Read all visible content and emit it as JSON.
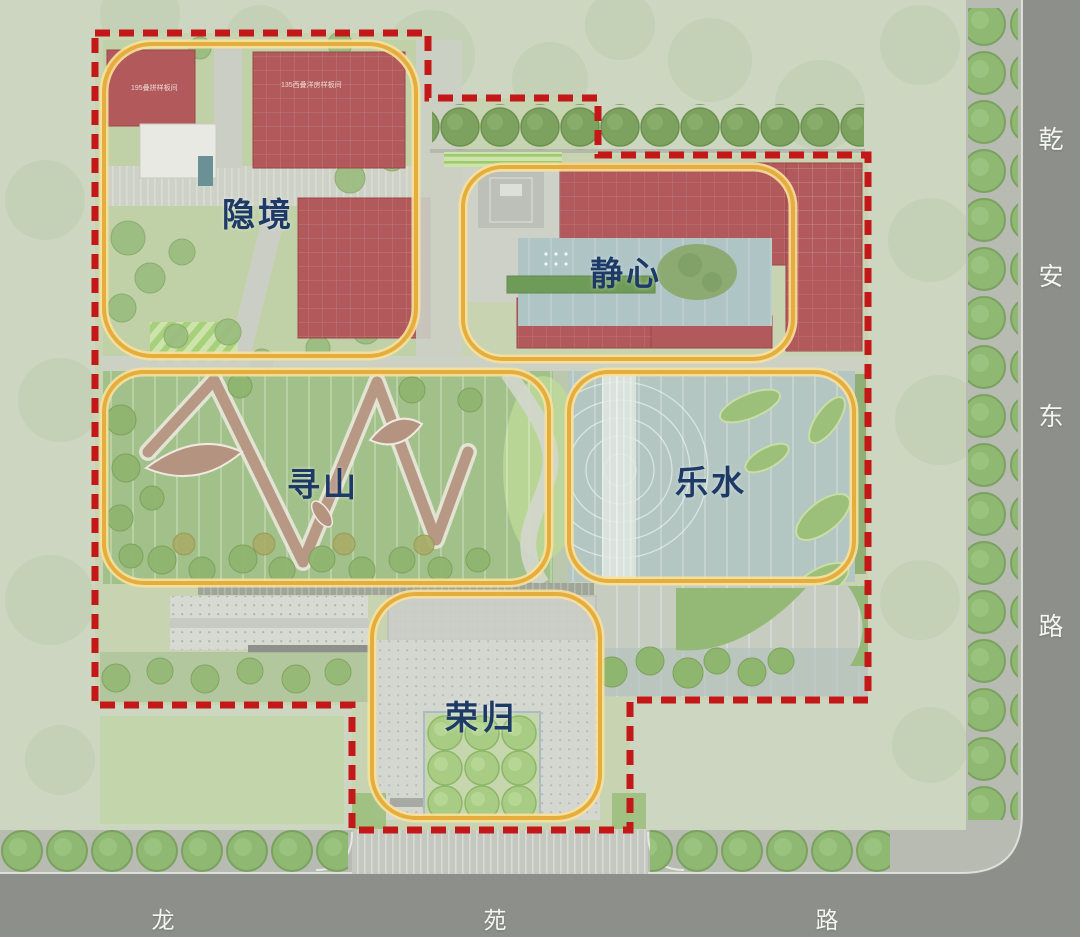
{
  "zones": [
    {
      "id": "yinjing",
      "label": "隐境"
    },
    {
      "id": "jingxin",
      "label": "静心"
    },
    {
      "id": "xunshan",
      "label": "寻山"
    },
    {
      "id": "leshui",
      "label": "乐水"
    },
    {
      "id": "ronggui",
      "label": "荣归"
    }
  ],
  "roads": {
    "east": {
      "name": "乾安东路",
      "chars": [
        "乾",
        "安",
        "东",
        "路"
      ]
    },
    "south": {
      "name": "龙苑路",
      "chars": [
        "龙",
        "苑",
        "路"
      ]
    }
  },
  "buildings": [
    {
      "label": "195叠拼样板间"
    },
    {
      "label": "135西叠洋房样板间"
    }
  ],
  "palette": {
    "boundary_red": "#c41717",
    "zone_outline_gold": "#e5ad3c",
    "zone_outline_halo": "#f8e09b",
    "label_navy": "#1d3a66",
    "road_gray": "#8d8f8b",
    "sidewalk_gray": "#b7bbb1",
    "building_red": "#b2595b",
    "water_teal": "#aec4c5",
    "lawn_green": "#a2c089",
    "site_green": "#c7d4b0",
    "background_green": "#ccd6c0",
    "road_label_white": "#f4f4f0"
  }
}
